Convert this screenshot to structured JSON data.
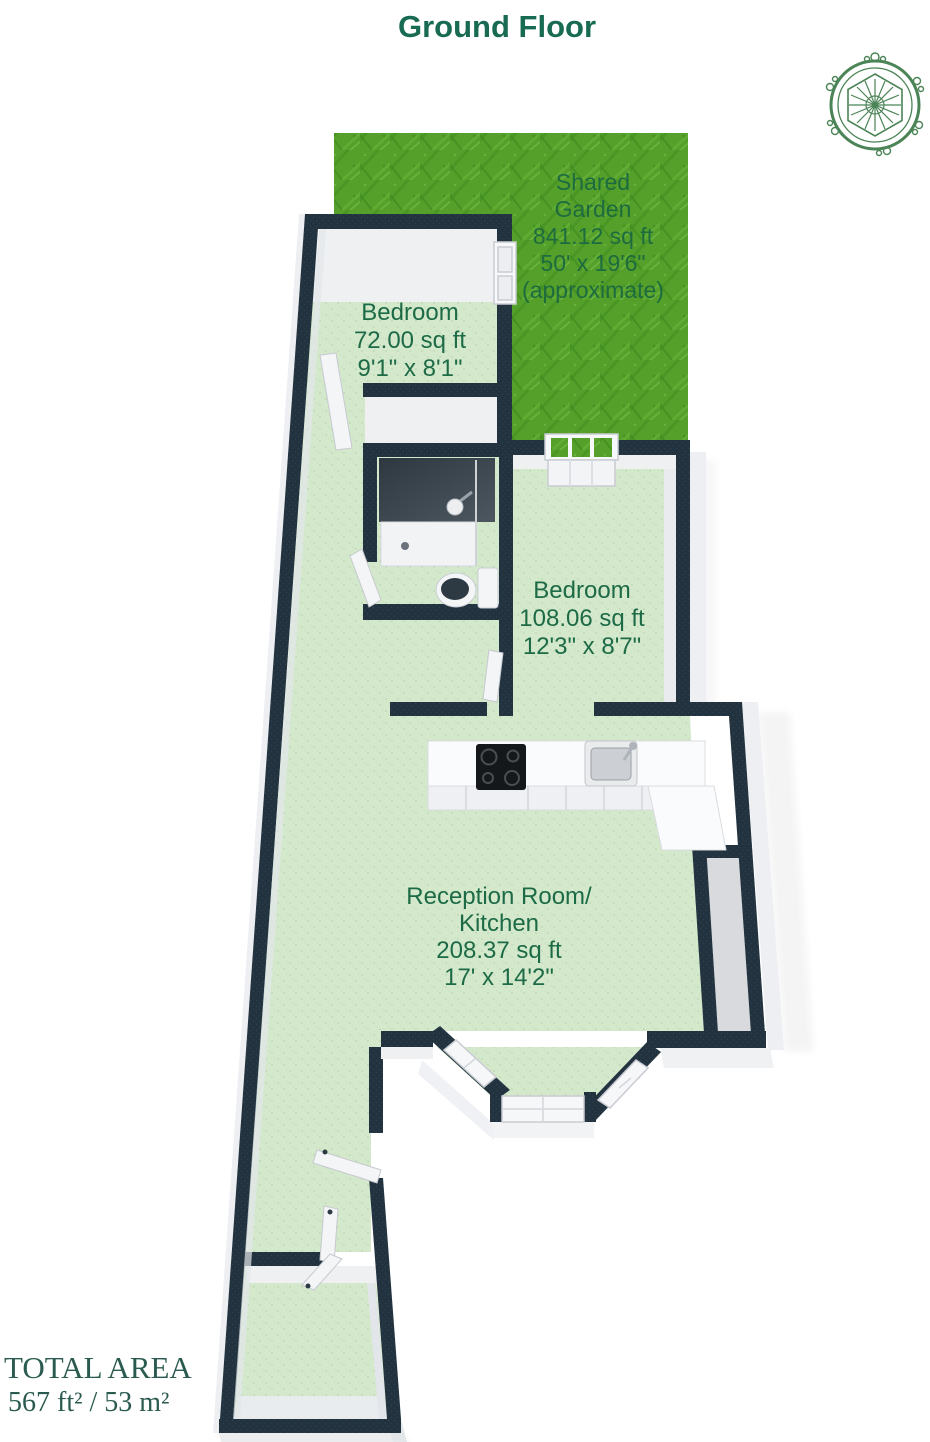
{
  "title": "Ground Floor",
  "garden": {
    "line1": "Shared",
    "line2": "Garden",
    "area": "841.12 sq ft",
    "dims": "50' x 19'6\"",
    "note": "(approximate)"
  },
  "rooms": {
    "bedroom1": {
      "name": "Bedroom",
      "area": "72.00 sq ft",
      "dims": "9'1\" x 8'1\""
    },
    "bedroom2": {
      "name": "Bedroom",
      "area": "108.06 sq ft",
      "dims": "12'3\" x 8'7\""
    },
    "reception": {
      "name_line1": "Reception Room/",
      "name_line2": "Kitchen",
      "area": "208.37 sq ft",
      "dims": "17' x 14'2\""
    }
  },
  "total": {
    "label": "TOTAL AREA",
    "value": "567 ft² / 53 m²"
  },
  "colors": {
    "wall": "#22333F",
    "floor": "#D3E7CB",
    "grass": "#55A02C",
    "room_label": "#1D6B46",
    "garden_label": "#1D6B3F",
    "title": "#186B52",
    "total_text": "#2B5B50",
    "logo": "#4B8456"
  }
}
